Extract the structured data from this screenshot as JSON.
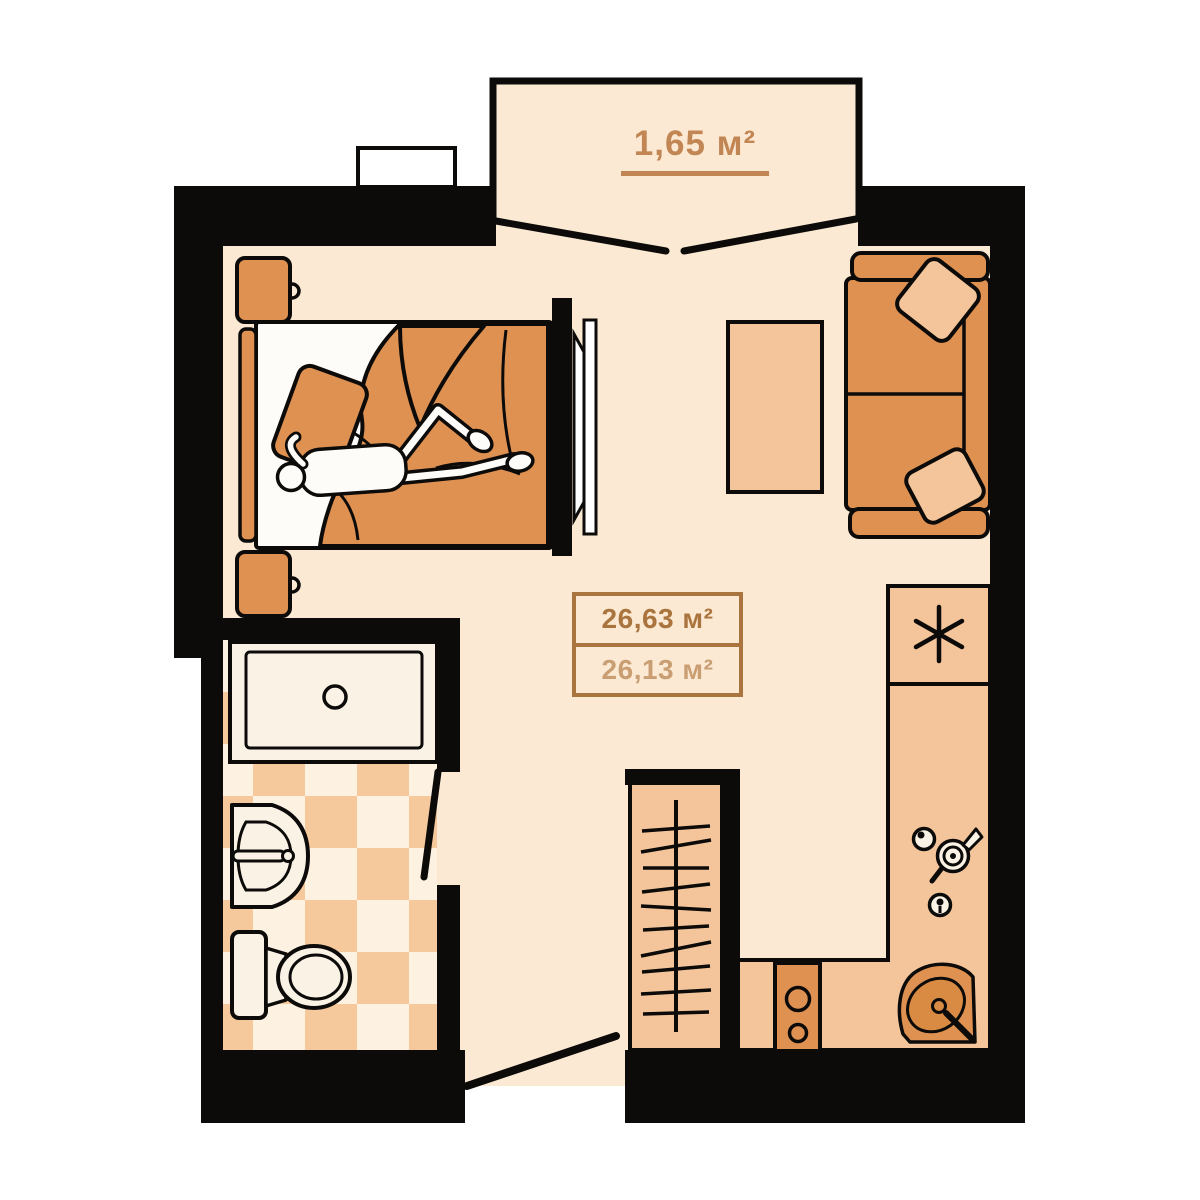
{
  "balcony": {
    "area_label": "1,65 м²"
  },
  "apartment": {
    "total_area_label": "26,63 м²",
    "living_area_label": "26,13 м²"
  },
  "icons": {
    "fridge": "asterisk-icon",
    "kitchen_hob": "kettle-and-burner-knob-icons",
    "wardrobe": "hanger-rail-icon"
  },
  "colors": {
    "background": "#ffffff",
    "wall": "#0c0b09",
    "floor": "#fbe9d3",
    "furniture_light": "#f4c59a",
    "furniture_medium": "#df9151",
    "checker_orange": "#f6c99d",
    "checker_cream": "#fdf1e1",
    "fixture_cream": "#fbf2e6",
    "label_accent": "#c28655",
    "area_text_primary": "#aa743e",
    "area_text_secondary": "#c99e73"
  }
}
